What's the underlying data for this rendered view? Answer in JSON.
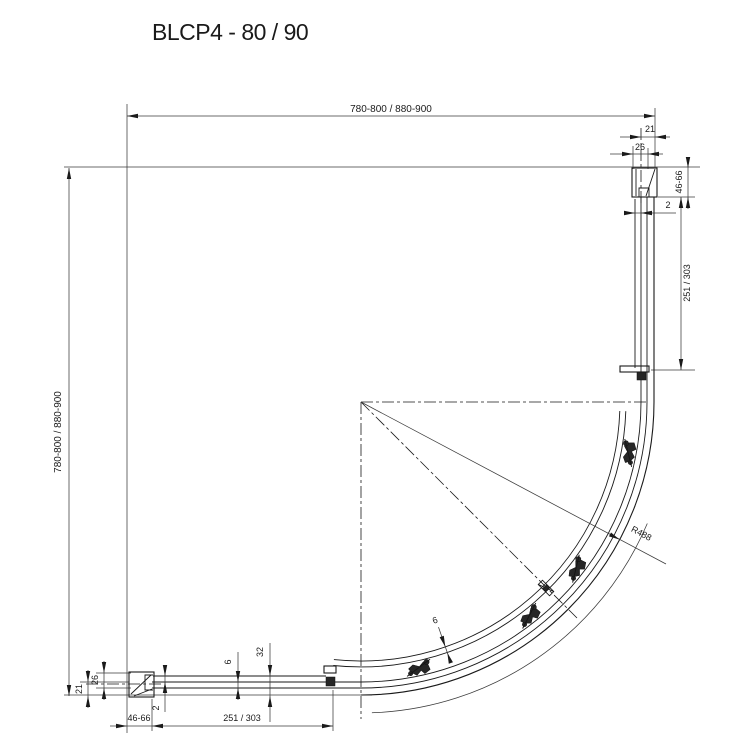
{
  "drawing": {
    "title": "BLCP4 - 80 / 90",
    "type": "quarter-round shower enclosure plan view"
  },
  "dims": {
    "top_width": "780-800 / 880-900",
    "left_height": "780-800 / 880-900",
    "radius": "R488",
    "top_right": {
      "offset21": "21",
      "depth26": "26",
      "adjust": "46-66",
      "gap2": "2",
      "segment": "251 / 303"
    },
    "bottom_left": {
      "offset21": "21",
      "depth26": "26",
      "adjust": "46-66",
      "gap2": "2",
      "segment": "251 / 303",
      "glass6": "6",
      "height32": "32"
    },
    "arc_glass6": "6"
  },
  "colors": {
    "line": "#1a1a1a",
    "background": "#ffffff"
  }
}
